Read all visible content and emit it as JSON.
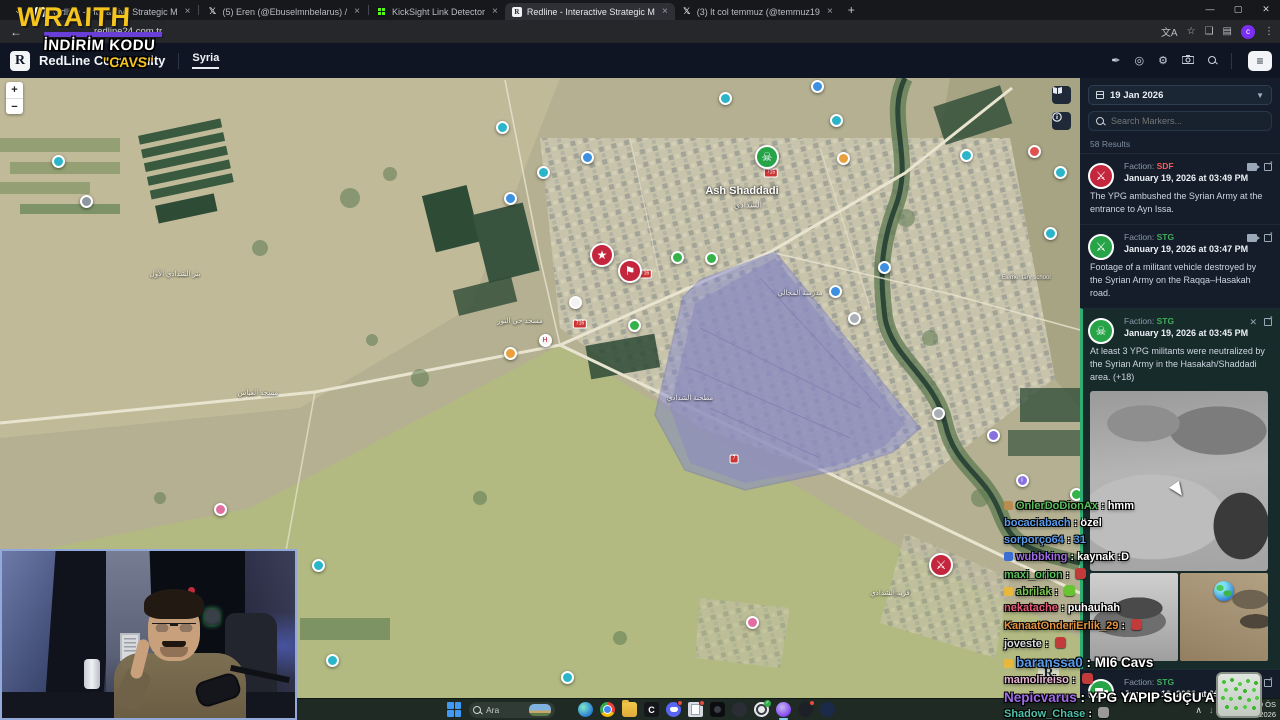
{
  "browser": {
    "tabs": [
      {
        "title": "Redline - Interactive Strategic M",
        "icon": "redline",
        "active": false
      },
      {
        "title": "(5) Eren (@Ebuselmnbelarus) /",
        "icon": "x",
        "active": false
      },
      {
        "title": "KickSight Link Detector",
        "icon": "kick",
        "active": false
      },
      {
        "title": "Redline - Interactive Strategic M",
        "icon": "redline",
        "active": true
      },
      {
        "title": "(3) lt col temmuz (@temmuz19",
        "icon": "x",
        "active": false
      }
    ],
    "new_tab": "+",
    "url": "redline24.com.tr",
    "avatar_letter": "c",
    "close_glyph": "×"
  },
  "site_header": {
    "logo_letter": "R",
    "title": "RedLine Community",
    "nav_item": "Syria"
  },
  "overlay_brand": {
    "brand": "WRAITH",
    "promo_line1": "İNDİRİM KODU",
    "promo_line2": "\"CAVS\""
  },
  "map": {
    "town_label": "Ash Shaddadi",
    "town_label_ar": "الشدادي",
    "zoom_in": "+",
    "zoom_out": "−",
    "labels": [
      {
        "x": 742,
        "y": 113,
        "t": "Ash Shaddadi",
        "s": 11,
        "b": true
      },
      {
        "x": 748,
        "y": 127,
        "t": "الشدادي",
        "s": 8,
        "b": false
      },
      {
        "x": 175,
        "y": 196,
        "t": "بئر الشدادي الأول",
        "s": 7,
        "b": false
      },
      {
        "x": 258,
        "y": 315,
        "t": "مسجد العباس",
        "s": 7,
        "b": false
      },
      {
        "x": 520,
        "y": 243,
        "t": "مسجد حي النور",
        "s": 7,
        "b": false
      },
      {
        "x": 800,
        "y": 215,
        "t": "مدرسة المجالي",
        "s": 7,
        "b": false
      },
      {
        "x": 1026,
        "y": 200,
        "t": "Elementary school",
        "s": 6,
        "b": false
      },
      {
        "x": 890,
        "y": 515,
        "t": "قرية الشدادي",
        "s": 7,
        "b": false
      },
      {
        "x": 690,
        "y": 320,
        "t": "مطحنة الشدادي",
        "s": 7,
        "b": false
      }
    ],
    "shields": [
      {
        "x": 771,
        "y": 95,
        "t": "715"
      },
      {
        "x": 645,
        "y": 196,
        "t": "716"
      },
      {
        "x": 580,
        "y": 246,
        "t": "716"
      },
      {
        "x": 734,
        "y": 381,
        "t": "7"
      }
    ],
    "markers": [
      {
        "x": 767,
        "y": 79,
        "kind": "big",
        "bg": "#27a348",
        "glyph": "☠",
        "name": "casualty-marker"
      },
      {
        "x": 602,
        "y": 177,
        "kind": "big",
        "bg": "#c4273d",
        "glyph": "★",
        "name": "clash-marker"
      },
      {
        "x": 630,
        "y": 193,
        "kind": "big",
        "bg": "#c4273d",
        "glyph": "⚑",
        "name": "announcement-marker"
      },
      {
        "x": 941,
        "y": 487,
        "kind": "big",
        "bg": "#c4273d",
        "glyph": "⚔",
        "name": "attack-marker"
      },
      {
        "x": 58,
        "y": 83,
        "kind": "small",
        "bg": "#2bb5c8",
        "glyph": "",
        "name": "poi-marker"
      },
      {
        "x": 86,
        "y": 123,
        "kind": "small",
        "bg": "#8f979e",
        "glyph": "",
        "name": "poi-marker"
      },
      {
        "x": 220,
        "y": 431,
        "kind": "small",
        "bg": "#e06fa0",
        "glyph": "",
        "name": "poi-marker"
      },
      {
        "x": 318,
        "y": 487,
        "kind": "small",
        "bg": "#2bb5c8",
        "glyph": "",
        "name": "poi-marker"
      },
      {
        "x": 332,
        "y": 582,
        "kind": "small",
        "bg": "#2bb5c8",
        "glyph": "",
        "name": "poi-marker"
      },
      {
        "x": 567,
        "y": 599,
        "kind": "small",
        "bg": "#2bb5c8",
        "glyph": "",
        "name": "poi-marker"
      },
      {
        "x": 502,
        "y": 49,
        "kind": "small",
        "bg": "#2bb5c8",
        "glyph": "",
        "name": "poi-marker"
      },
      {
        "x": 510,
        "y": 120,
        "kind": "small",
        "bg": "#3d8fe0",
        "glyph": "",
        "name": "poi-marker"
      },
      {
        "x": 543,
        "y": 94,
        "kind": "small",
        "bg": "#2bb5c8",
        "glyph": "",
        "name": "poi-marker"
      },
      {
        "x": 587,
        "y": 79,
        "kind": "small",
        "bg": "#3d8fe0",
        "glyph": "",
        "name": "poi-marker"
      },
      {
        "x": 575,
        "y": 224,
        "kind": "small",
        "bg": "#f2f2f2",
        "glyph": "",
        "name": "poi-marker"
      },
      {
        "x": 545,
        "y": 262,
        "kind": "small",
        "bg": "#f2f2f2",
        "glyph": "H",
        "fg": "#c4273d",
        "name": "hospital-marker"
      },
      {
        "x": 510,
        "y": 275,
        "kind": "small",
        "bg": "#e8a13d",
        "glyph": "",
        "name": "poi-marker"
      },
      {
        "x": 634,
        "y": 247,
        "kind": "small",
        "bg": "#35b34a",
        "glyph": "",
        "name": "poi-marker"
      },
      {
        "x": 677,
        "y": 179,
        "kind": "small",
        "bg": "#35b34a",
        "glyph": "",
        "name": "poi-marker"
      },
      {
        "x": 711,
        "y": 180,
        "kind": "small",
        "bg": "#35b34a",
        "glyph": "",
        "name": "poi-marker"
      },
      {
        "x": 725,
        "y": 20,
        "kind": "small",
        "bg": "#2bb5c8",
        "glyph": "",
        "name": "poi-marker"
      },
      {
        "x": 817,
        "y": 8,
        "kind": "small",
        "bg": "#3d8fe0",
        "glyph": "",
        "name": "poi-marker"
      },
      {
        "x": 836,
        "y": 42,
        "kind": "small",
        "bg": "#2bb5c8",
        "glyph": "",
        "name": "poi-marker"
      },
      {
        "x": 843,
        "y": 80,
        "kind": "small",
        "bg": "#e8a13d",
        "glyph": "",
        "name": "poi-marker"
      },
      {
        "x": 884,
        "y": 189,
        "kind": "small",
        "bg": "#3d8fe0",
        "glyph": "",
        "name": "poi-marker"
      },
      {
        "x": 854,
        "y": 240,
        "kind": "small",
        "bg": "#aab0b6",
        "glyph": "",
        "name": "poi-marker"
      },
      {
        "x": 835,
        "y": 213,
        "kind": "small",
        "bg": "#3d8fe0",
        "glyph": "",
        "name": "poi-marker"
      },
      {
        "x": 938,
        "y": 335,
        "kind": "small",
        "bg": "#aab0b6",
        "glyph": "",
        "name": "poi-marker"
      },
      {
        "x": 993,
        "y": 357,
        "kind": "small",
        "bg": "#8a6fe0",
        "glyph": "",
        "name": "poi-marker"
      },
      {
        "x": 1022,
        "y": 402,
        "kind": "small",
        "bg": "#8a6fe0",
        "glyph": "i",
        "name": "info-marker"
      },
      {
        "x": 1050,
        "y": 155,
        "kind": "small",
        "bg": "#2bb5c8",
        "glyph": "",
        "name": "poi-marker"
      },
      {
        "x": 1060,
        "y": 94,
        "kind": "small",
        "bg": "#2bb5c8",
        "glyph": "",
        "name": "poi-marker"
      },
      {
        "x": 1034,
        "y": 73,
        "kind": "small",
        "bg": "#e05252",
        "glyph": "",
        "name": "poi-marker"
      },
      {
        "x": 966,
        "y": 77,
        "kind": "small",
        "bg": "#2bb5c8",
        "glyph": "",
        "name": "poi-marker"
      },
      {
        "x": 752,
        "y": 544,
        "kind": "small",
        "bg": "#e06fa0",
        "glyph": "",
        "name": "poi-marker"
      },
      {
        "x": 1076,
        "y": 416,
        "kind": "small",
        "bg": "#35b34a",
        "glyph": "",
        "name": "poi-marker"
      }
    ]
  },
  "sidebar": {
    "date": "19 Jan 2026",
    "search_placeholder": "Search Markers...",
    "results_count": "58 Results",
    "faction_label": "Faction:",
    "entries": [
      {
        "faction": "SDF",
        "faction_color": "#ff5a5a",
        "time": "January 19, 2026 at 03:49 PM",
        "text": "The YPG ambushed the Syrian Army at the entrance to Ayn Issa.",
        "icon_bg": "#c4273d",
        "icon_glyph": "⚔"
      },
      {
        "faction": "STG",
        "faction_color": "#3fae5a",
        "time": "January 19, 2026 at 03:47 PM",
        "text": "Footage of a militant vehicle destroyed by the Syrian Army on the Raqqa–Hasakah road.",
        "icon_bg": "#27a348",
        "icon_glyph": "⚔"
      },
      {
        "faction": "STG",
        "faction_color": "#3fae5a",
        "time": "January 19, 2026 at 03:45 PM",
        "text": "At least 3 YPG militants were neutralized by the Syrian Army in the Hasakah/Shaddadi area. (+18)",
        "icon_bg": "#27a348",
        "icon_glyph": "☠"
      },
      {
        "faction": "STG",
        "faction_color": "#3fae5a",
        "time": "January 19, 2026 at 03:42 PM",
        "text": "The Syrian Army has taken control of the village of Umm Madfa, located southwest of Hasakah ... are advancing",
        "icon_bg": "#27a348",
        "icon_glyph": "truck"
      }
    ]
  },
  "chat": {
    "lines": [
      {
        "y": 500,
        "user": "OnlerDoDionAx",
        "color": "#57c05a",
        "msg": "hmm",
        "badge": "#b98d4f"
      },
      {
        "y": 517,
        "user": "bocaciabach",
        "color": "#5a9bec",
        "msg": "özel"
      },
      {
        "y": 534,
        "user": "sorporço64",
        "color": "#5a9bec",
        "msg": "31",
        "msg_color": "#5a9bec"
      },
      {
        "y": 551,
        "user": "wubbking",
        "color": "#a06be8",
        "msg": "kaynak :D",
        "badge": "#3b6fd4"
      },
      {
        "y": 568,
        "user": "maxi_orion",
        "color": "#57c05a",
        "msg": "",
        "emote": "#c23b3b"
      },
      {
        "y": 585,
        "user": "abrilak",
        "color": "#7ac74f",
        "msg": "",
        "badge": "#e8b83d",
        "emote": "#69c431"
      },
      {
        "y": 602,
        "user": "nekatache",
        "color": "#ec5a7a",
        "msg": "puhauhah"
      },
      {
        "y": 619,
        "user": "KanaatOnderiErlik_29",
        "color": "#e8923d",
        "msg": "",
        "emote": "#c23b3b"
      },
      {
        "y": 637,
        "user": "joveste",
        "color": "#d8dde2",
        "msg": "",
        "emote": "#c23b3b"
      },
      {
        "y": 655,
        "user": "baranssa0",
        "color": "#5a9bec",
        "msg": "MI6 Cavs",
        "badge": "#e8b83d",
        "big": true
      },
      {
        "y": 673,
        "user": "mamolireiso",
        "color": "#eab6d8",
        "msg": "",
        "emote": "#c23b3b"
      },
      {
        "y": 690,
        "user": "Nepicvarus",
        "color": "#a06be8",
        "msg": "YPG YAPIP SUÇU ATIYO",
        "big": true
      },
      {
        "y": 707,
        "user": "Shadow_Chase",
        "color": "#4fc0a8",
        "msg": "",
        "emote": "#9a9a9a"
      }
    ]
  },
  "taskbar": {
    "search_placeholder": "Ara",
    "tray_time": "3:49 ÖS",
    "tray_date": "19.01.2026",
    "apps": [
      {
        "cls": "a-edge",
        "name": "edge-icon"
      },
      {
        "cls": "a-chrome",
        "name": "chrome-icon"
      },
      {
        "cls": "a-folder",
        "name": "file-explorer-icon"
      },
      {
        "cls": "a-capcut",
        "name": "capcut-icon",
        "glyph": "C"
      },
      {
        "cls": "a-discord",
        "name": "discord-icon",
        "dot": true
      },
      {
        "cls": "a-doc",
        "name": "notes-app-icon",
        "dot": true
      },
      {
        "cls": "a-black",
        "name": "app-icon-dark"
      },
      {
        "cls": "a-dark",
        "name": "app-icon-gray"
      },
      {
        "cls": "a-obs",
        "name": "obs-icon",
        "chk": true
      },
      {
        "cls": "a-profile",
        "name": "browser-profile-icon",
        "activebar": true
      },
      {
        "cls": "a-redbadge",
        "name": "app-icon-badge",
        "dot": true
      },
      {
        "cls": "a-navy",
        "name": "app-icon-navy"
      }
    ]
  }
}
